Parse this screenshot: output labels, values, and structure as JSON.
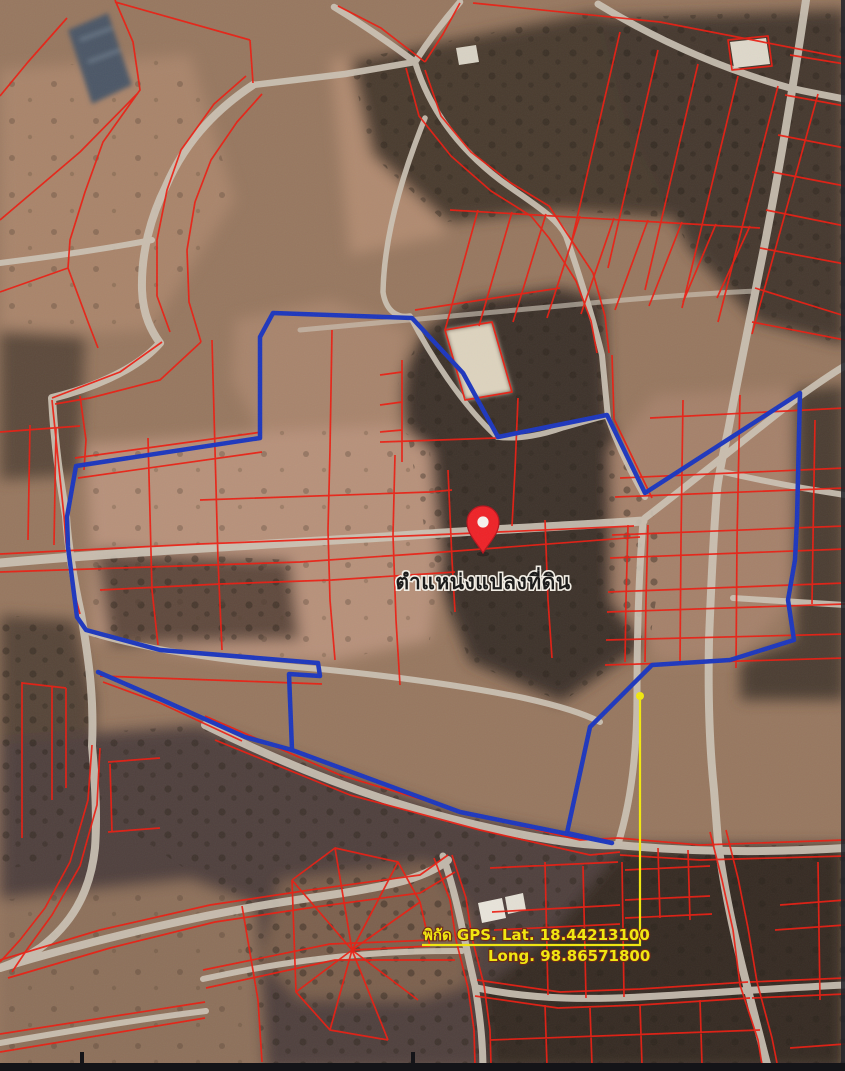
{
  "map": {
    "marker_label": "ตำแหน่งแปลงที่ดิน",
    "gps_line1": "พิกัด GPS. Lat. 18.44213100",
    "gps_line2": "Long. 98.86571800"
  },
  "marker": {
    "transform": "translate(483,553)",
    "pin_color": "#ee2227",
    "pin_edge_color": "#b5131c",
    "label_x": "483",
    "label_y": "589"
  },
  "annotation": {
    "color": "#f2e80c",
    "dot_x": "640",
    "dot_y": "696",
    "leader_points": "640,700 640,945 422,945",
    "text1_x": "423",
    "text1_y": "940",
    "text2_x": "488",
    "text2_y": "961"
  },
  "parcel_outline": {
    "color": "#1c36bd",
    "main_points": "273,313 412,318 463,373 498,437 607,415 645,493 800,393 797,520 795,560 788,600 794,640 730,660 652,665 590,727 567,833 612,843 460,812 292,750 289,674 320,676 318,663 160,650 86,630 77,617 68,547 67,517 76,466 260,438 260,337 273,313",
    "spur_points": "98,672 160,699 245,737 292,750"
  },
  "cadastral": {
    "line_color": "#ec1c10"
  },
  "roads": {
    "color": "#cdc4b6"
  },
  "scan": {
    "bottom_bar_color": "#141418",
    "edge_line_color": "#23232a"
  }
}
